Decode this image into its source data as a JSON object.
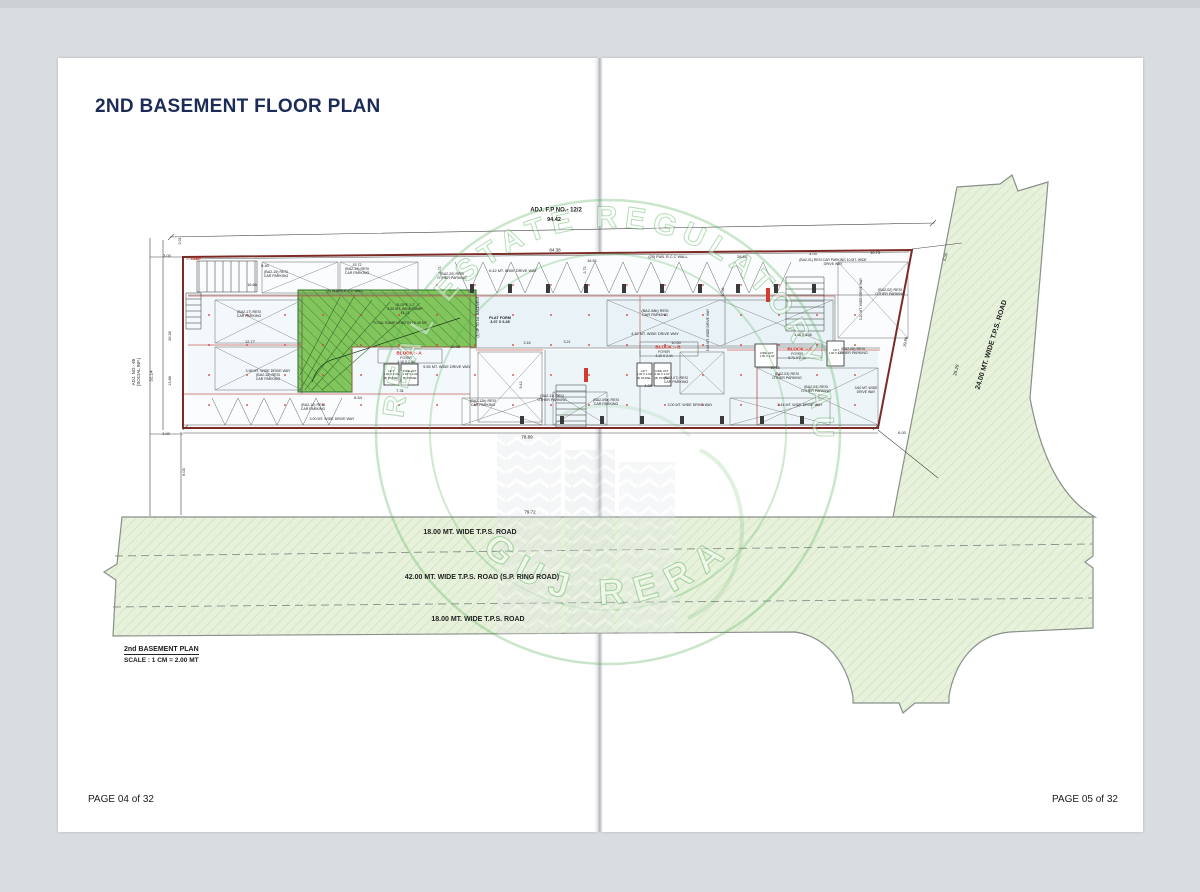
{
  "page": {
    "title": "2ND BASEMENT FLOOR PLAN",
    "footer_left": "PAGE 04 of 32",
    "footer_right": "PAGE 05 of 32"
  },
  "scale_box": {
    "name": "2nd BASEMENT PLAN",
    "scale": "SCALE : 1 CM = 2.00 MT"
  },
  "watermark": {
    "ring_text": "GUJARAT REAL ESTATE REGULATORY AUTHORITY",
    "bottom_text": "GUJ RERA"
  },
  "colors": {
    "title_navy": "#1d2b57",
    "plan_outline_maroon": "#7b2a26",
    "block_label_red": "#d42a20",
    "ramp_green": "#82c55c",
    "road_green": "#e7f1dc",
    "watermark_green": "#4fae54"
  },
  "annotations": [
    {
      "t": "ADJ. F.P NO.- 12/2",
      "x": 556,
      "y": 211,
      "s": 6,
      "w": 1
    },
    {
      "t": "94.42",
      "x": 554,
      "y": 220,
      "s": 5.5,
      "w": 1
    },
    {
      "t": "84.38",
      "x": 555,
      "y": 250,
      "s": 4.5
    },
    {
      "t": "16.51",
      "x": 592,
      "y": 261,
      "s": 4
    },
    {
      "t": "(25) PUB. R.C.C WALL",
      "x": 668,
      "y": 257,
      "s": 3.8
    },
    {
      "t": "28.84",
      "x": 742,
      "y": 257,
      "s": 4
    },
    {
      "t": "8.40",
      "x": 265,
      "y": 266,
      "s": 4
    },
    {
      "t": "(BA2-15) RESI\nCAR PARKING",
      "x": 276,
      "y": 274,
      "s": 3.6
    },
    {
      "t": "15.72\n(BA2-19) RESI\nCAR PARKING",
      "x": 357,
      "y": 269,
      "s": 3.6
    },
    {
      "t": "(BA2-20) RESI\nOTHER PARKING",
      "x": 452,
      "y": 276,
      "s": 3.6
    },
    {
      "t": "6.42 MT. WIDE DRIVE WAY",
      "x": 513,
      "y": 271,
      "s": 3.8
    },
    {
      "t": "3.73",
      "x": 440,
      "y": 270,
      "s": 3.6,
      "r": -90
    },
    {
      "t": "3.73",
      "x": 585,
      "y": 270,
      "s": 3.6,
      "r": -90
    },
    {
      "t": "(BA2-08b) RESI\nCAR PARKING",
      "x": 655,
      "y": 313,
      "s": 3.8
    },
    {
      "t": "4.32 MT. WIDE DRIVE WAY",
      "x": 655,
      "y": 334,
      "s": 3.8
    },
    {
      "t": "PLAT FORM\n3.07 X 6.45",
      "x": 500,
      "y": 320,
      "s": 3.8,
      "w": 1
    },
    {
      "t": "SLOPE 1:7\n3.00 MT. WIDE RAMP\n41.21",
      "x": 405,
      "y": 309,
      "s": 3.6
    },
    {
      "t": "TOTAL RAMP LENGTH 75.49 MT",
      "x": 400,
      "y": 323,
      "s": 3.6
    },
    {
      "t": "(2) SLOPE R.C.C WALL",
      "x": 345,
      "y": 292,
      "s": 3.4
    },
    {
      "t": "(3) UP TO 1st. BASEMENT",
      "x": 479,
      "y": 317,
      "s": 3.4,
      "r": -90
    },
    {
      "t": "16.66",
      "x": 252,
      "y": 285,
      "s": 3.8
    },
    {
      "t": "(BA2-17) RESI\nCAR PARKING",
      "x": 249,
      "y": 314,
      "s": 3.6
    },
    {
      "t": "12.77",
      "x": 250,
      "y": 342,
      "s": 4
    },
    {
      "t": "3.98 MT. WIDE DRIVE WAY\n(BA2-18) RESI\nCAR PARKING",
      "x": 268,
      "y": 375,
      "s": 3.6
    },
    {
      "t": "BLOCK :- A",
      "x": 409,
      "y": 353,
      "s": 4.6,
      "c": "r",
      "w": 1
    },
    {
      "t": "FOYER\n4.10 X 2.44",
      "x": 406,
      "y": 361,
      "s": 3.4
    },
    {
      "t": "LIFT\n1.90 X 2.00\n(8) PASSE.",
      "x": 391,
      "y": 375,
      "s": 2.9
    },
    {
      "t": "FIRE LIFT\n1.90 X 2.00\n(8) PASSE.",
      "x": 410,
      "y": 375,
      "s": 2.9
    },
    {
      "t": "12.38",
      "x": 455,
      "y": 347,
      "s": 4
    },
    {
      "t": "5.55 MT. WIDE DRIVE WAY",
      "x": 447,
      "y": 367,
      "s": 3.8
    },
    {
      "t": "7.31",
      "x": 400,
      "y": 391,
      "s": 4
    },
    {
      "t": "6.54",
      "x": 358,
      "y": 398,
      "s": 4
    },
    {
      "t": "(BA2-12b) RESI\nCAR PARKING",
      "x": 483,
      "y": 403,
      "s": 3.6
    },
    {
      "t": "(BA2-10) RESI\nCAR PARKING",
      "x": 313,
      "y": 407,
      "s": 3.6
    },
    {
      "t": "3.00 MT. WIDE DRIVE WAY",
      "x": 332,
      "y": 419,
      "s": 3.6
    },
    {
      "t": "BLOCK :- B",
      "x": 668,
      "y": 347,
      "s": 4.6,
      "c": "r",
      "w": 1
    },
    {
      "t": "FOYER\n4.10 X 2.44",
      "x": 664,
      "y": 355,
      "s": 3.4
    },
    {
      "t": "LIFT\n1.90 X 2.00\n(8) PASSE.",
      "x": 644,
      "y": 375,
      "s": 2.9
    },
    {
      "t": "FIRE LIFT\n1.90 X 2.00\n(8) PASSE.",
      "x": 662,
      "y": 375,
      "s": 2.9
    },
    {
      "t": "4.20",
      "x": 648,
      "y": 386,
      "s": 3.8
    },
    {
      "t": "(BA2-11) RESI\nOTHER PARKING",
      "x": 552,
      "y": 398,
      "s": 3.6
    },
    {
      "t": "(BA2-09a) RESI\nCAR PARKING",
      "x": 606,
      "y": 402,
      "s": 3.6
    },
    {
      "t": "(BA2-07) RESI\nCAR PARKING",
      "x": 676,
      "y": 380,
      "s": 3.6
    },
    {
      "t": "3.00 MT. WIDE DRIVE WAY",
      "x": 690,
      "y": 405,
      "s": 3.6
    },
    {
      "t": "10.50",
      "x": 676,
      "y": 343,
      "s": 3.8
    },
    {
      "t": "3.16",
      "x": 527,
      "y": 343,
      "s": 3.6
    },
    {
      "t": "3.21",
      "x": 567,
      "y": 342,
      "s": 3.6
    },
    {
      "t": "9.42",
      "x": 521,
      "y": 385,
      "s": 3.6,
      "r": -90
    },
    {
      "t": "BLOCK :- C",
      "x": 800,
      "y": 349,
      "s": 4.6,
      "c": "r",
      "w": 1
    },
    {
      "t": "FOYER\n5.71 X 2.44",
      "x": 797,
      "y": 357,
      "s": 3.4
    },
    {
      "t": "FIRE LIFT\n1.90 X 2.00",
      "x": 767,
      "y": 355,
      "s": 2.9
    },
    {
      "t": "LIFT\n1.90 X 2.00",
      "x": 836,
      "y": 352,
      "s": 2.9
    },
    {
      "t": "4.15 X 3.48",
      "x": 803,
      "y": 336,
      "s": 3.4
    },
    {
      "t": "(BA2-03) RESI\nOTHER PARKING",
      "x": 787,
      "y": 376,
      "s": 3.6
    },
    {
      "t": "10.16",
      "x": 775,
      "y": 368,
      "s": 3.8
    },
    {
      "t": "(BA2-06) RESI\nOTHER PARKING",
      "x": 853,
      "y": 351,
      "s": 3.6
    },
    {
      "t": "(BA2-04) RESI\nOTHER PARKING",
      "x": 816,
      "y": 389,
      "s": 3.6
    },
    {
      "t": "2.44 MT. WIDE DRIVE WAY",
      "x": 800,
      "y": 405,
      "s": 3.6
    },
    {
      "t": "3.60 MT. WIDE\nDRIVE WAY",
      "x": 866,
      "y": 391,
      "s": 3.4
    },
    {
      "t": "(BA2-02) RESI\nOTHER PARKING",
      "x": 890,
      "y": 292,
      "s": 3.6
    },
    {
      "t": "3.20 MT. WIDE DRIVE WAY",
      "x": 862,
      "y": 299,
      "s": 3.4,
      "r": -90
    },
    {
      "t": "5.63 MT. WIDE DRIVE WAY",
      "x": 709,
      "y": 330,
      "s": 3.4,
      "r": -90
    },
    {
      "t": "10.56",
      "x": 723,
      "y": 292,
      "s": 3.6,
      "r": -90
    },
    {
      "t": "(BA2-01) RESI CAR PARKING 10 MT. WIDE\nDRIVE WAY",
      "x": 833,
      "y": 263,
      "s": 3.4
    },
    {
      "t": "4.03",
      "x": 813,
      "y": 254,
      "s": 3.8
    },
    {
      "t": "10.73",
      "x": 875,
      "y": 253,
      "s": 4
    },
    {
      "t": "29.80",
      "x": 906,
      "y": 342,
      "s": 4,
      "r": -79
    },
    {
      "t": "26.29",
      "x": 956,
      "y": 370,
      "s": 4.5,
      "r": -76
    },
    {
      "t": "6.00",
      "x": 946,
      "y": 257,
      "s": 4,
      "r": -76
    },
    {
      "t": "6.00",
      "x": 902,
      "y": 433,
      "s": 4
    },
    {
      "t": "78.89",
      "x": 527,
      "y": 437,
      "s": 4.5
    },
    {
      "t": "79.72",
      "x": 530,
      "y": 512,
      "s": 4.5
    },
    {
      "t": "6.00",
      "x": 184,
      "y": 472,
      "s": 4,
      "r": -90
    },
    {
      "t": "3.00",
      "x": 166,
      "y": 434,
      "s": 3.8
    },
    {
      "t": "3.00",
      "x": 167,
      "y": 256,
      "s": 3.8
    },
    {
      "t": "3.01",
      "x": 180,
      "y": 241,
      "s": 3.6,
      "r": -90
    },
    {
      "t": "26.36",
      "x": 170,
      "y": 336,
      "s": 3.8,
      "r": -90
    },
    {
      "t": "13.88",
      "x": 170,
      "y": 381,
      "s": 3.8,
      "r": -90
    },
    {
      "t": "32.14",
      "x": 151,
      "y": 376,
      "s": 4.5,
      "r": -90
    },
    {
      "t": "ADJ. NO.- 65\n(SOCIAL INF.)",
      "x": 136,
      "y": 372,
      "s": 4.5,
      "r": -90
    },
    {
      "t": "RAMP",
      "x": 196,
      "y": 260,
      "s": 3.2,
      "c": "r",
      "w": 1
    },
    {
      "t": "18.00 MT.  WIDE  T.P.S.  ROAD",
      "x": 470,
      "y": 533,
      "s": 7,
      "w": 1
    },
    {
      "t": "42.00 MT.  WIDE  T.P.S.  ROAD (S.P. RING ROAD)",
      "x": 482,
      "y": 578,
      "s": 7,
      "w": 1
    },
    {
      "t": "18.00 MT.  WIDE  T.P.S.  ROAD",
      "x": 478,
      "y": 620,
      "s": 7,
      "w": 1
    },
    {
      "t": "24.00 MT.  WIDE  T.P.S.  ROAD",
      "x": 992,
      "y": 345,
      "s": 7,
      "w": 1,
      "r": -73
    }
  ]
}
